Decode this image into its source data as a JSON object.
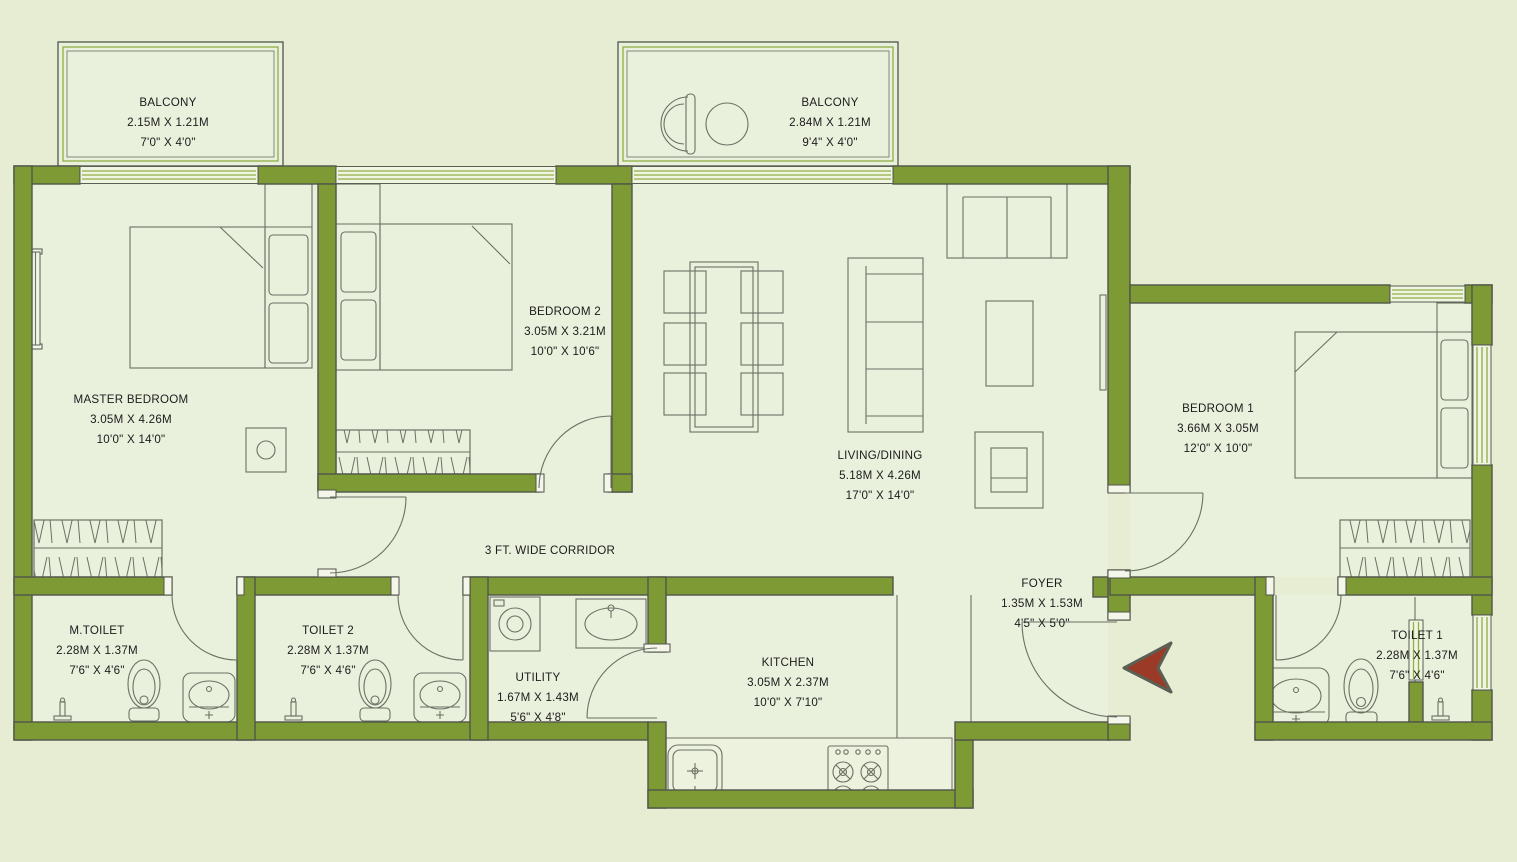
{
  "plan_type": "apartment-floor-plan",
  "colors": {
    "background": "#e6edd2",
    "floor": "#e9f0dc",
    "wall": "#7d9a34",
    "wall_outline": "#50554a",
    "window_stripe": "#8fae45",
    "line": "#6b7164",
    "text": "#1c1c1c",
    "entry_arrow": "#9a3a27"
  },
  "rooms": {
    "balcony_1": {
      "name": "BALCONY",
      "metric": "2.15M X 1.21M",
      "imperial": "7'0\" X 4'0\""
    },
    "balcony_2": {
      "name": "BALCONY",
      "metric": "2.84M X 1.21M",
      "imperial": "9'4\" X 4'0\""
    },
    "master_bedroom": {
      "name": "MASTER BEDROOM",
      "metric": "3.05M X 4.26M",
      "imperial": "10'0\" X 14'0\""
    },
    "bedroom_2": {
      "name": "BEDROOM 2",
      "metric": "3.05M X 3.21M",
      "imperial": "10'0\" X 10'6\""
    },
    "living_dining": {
      "name": "LIVING/DINING",
      "metric": "5.18M X 4.26M",
      "imperial": "17'0\" X 14'0\""
    },
    "bedroom_1": {
      "name": "BEDROOM 1",
      "metric": "3.66M X 3.05M",
      "imperial": "12'0\" X 10'0\""
    },
    "corridor": {
      "name": "3 FT. WIDE CORRIDOR"
    },
    "m_toilet": {
      "name": "M.TOILET",
      "metric": "2.28M X 1.37M",
      "imperial": "7'6\" X 4'6\""
    },
    "toilet_2": {
      "name": "TOILET 2",
      "metric": "2.28M X 1.37M",
      "imperial": "7'6\" X 4'6\""
    },
    "utility": {
      "name": "UTILITY",
      "metric": "1.67M X 1.43M",
      "imperial": "5'6\" X 4'8\""
    },
    "kitchen": {
      "name": "KITCHEN",
      "metric": "3.05M X 2.37M",
      "imperial": "10'0\" X 7'10\""
    },
    "foyer": {
      "name": "FOYER",
      "metric": "1.35M X 1.53M",
      "imperial": "4'5\" X 5'0\""
    },
    "toilet_1": {
      "name": "TOILET 1",
      "metric": "2.28M X 1.37M",
      "imperial": "7'6\" X 4'6\""
    }
  },
  "furniture_symbols": [
    "double-bed",
    "wardrobe",
    "dining-table",
    "dining-chair",
    "sofa",
    "loveseat",
    "armchair",
    "coffee-table",
    "tv-unit",
    "kitchen-sink",
    "gas-stove",
    "washing-machine",
    "utility-sink",
    "wc",
    "washbasin",
    "shower",
    "balcony-chair",
    "balcony-table",
    "entry-arrow"
  ]
}
